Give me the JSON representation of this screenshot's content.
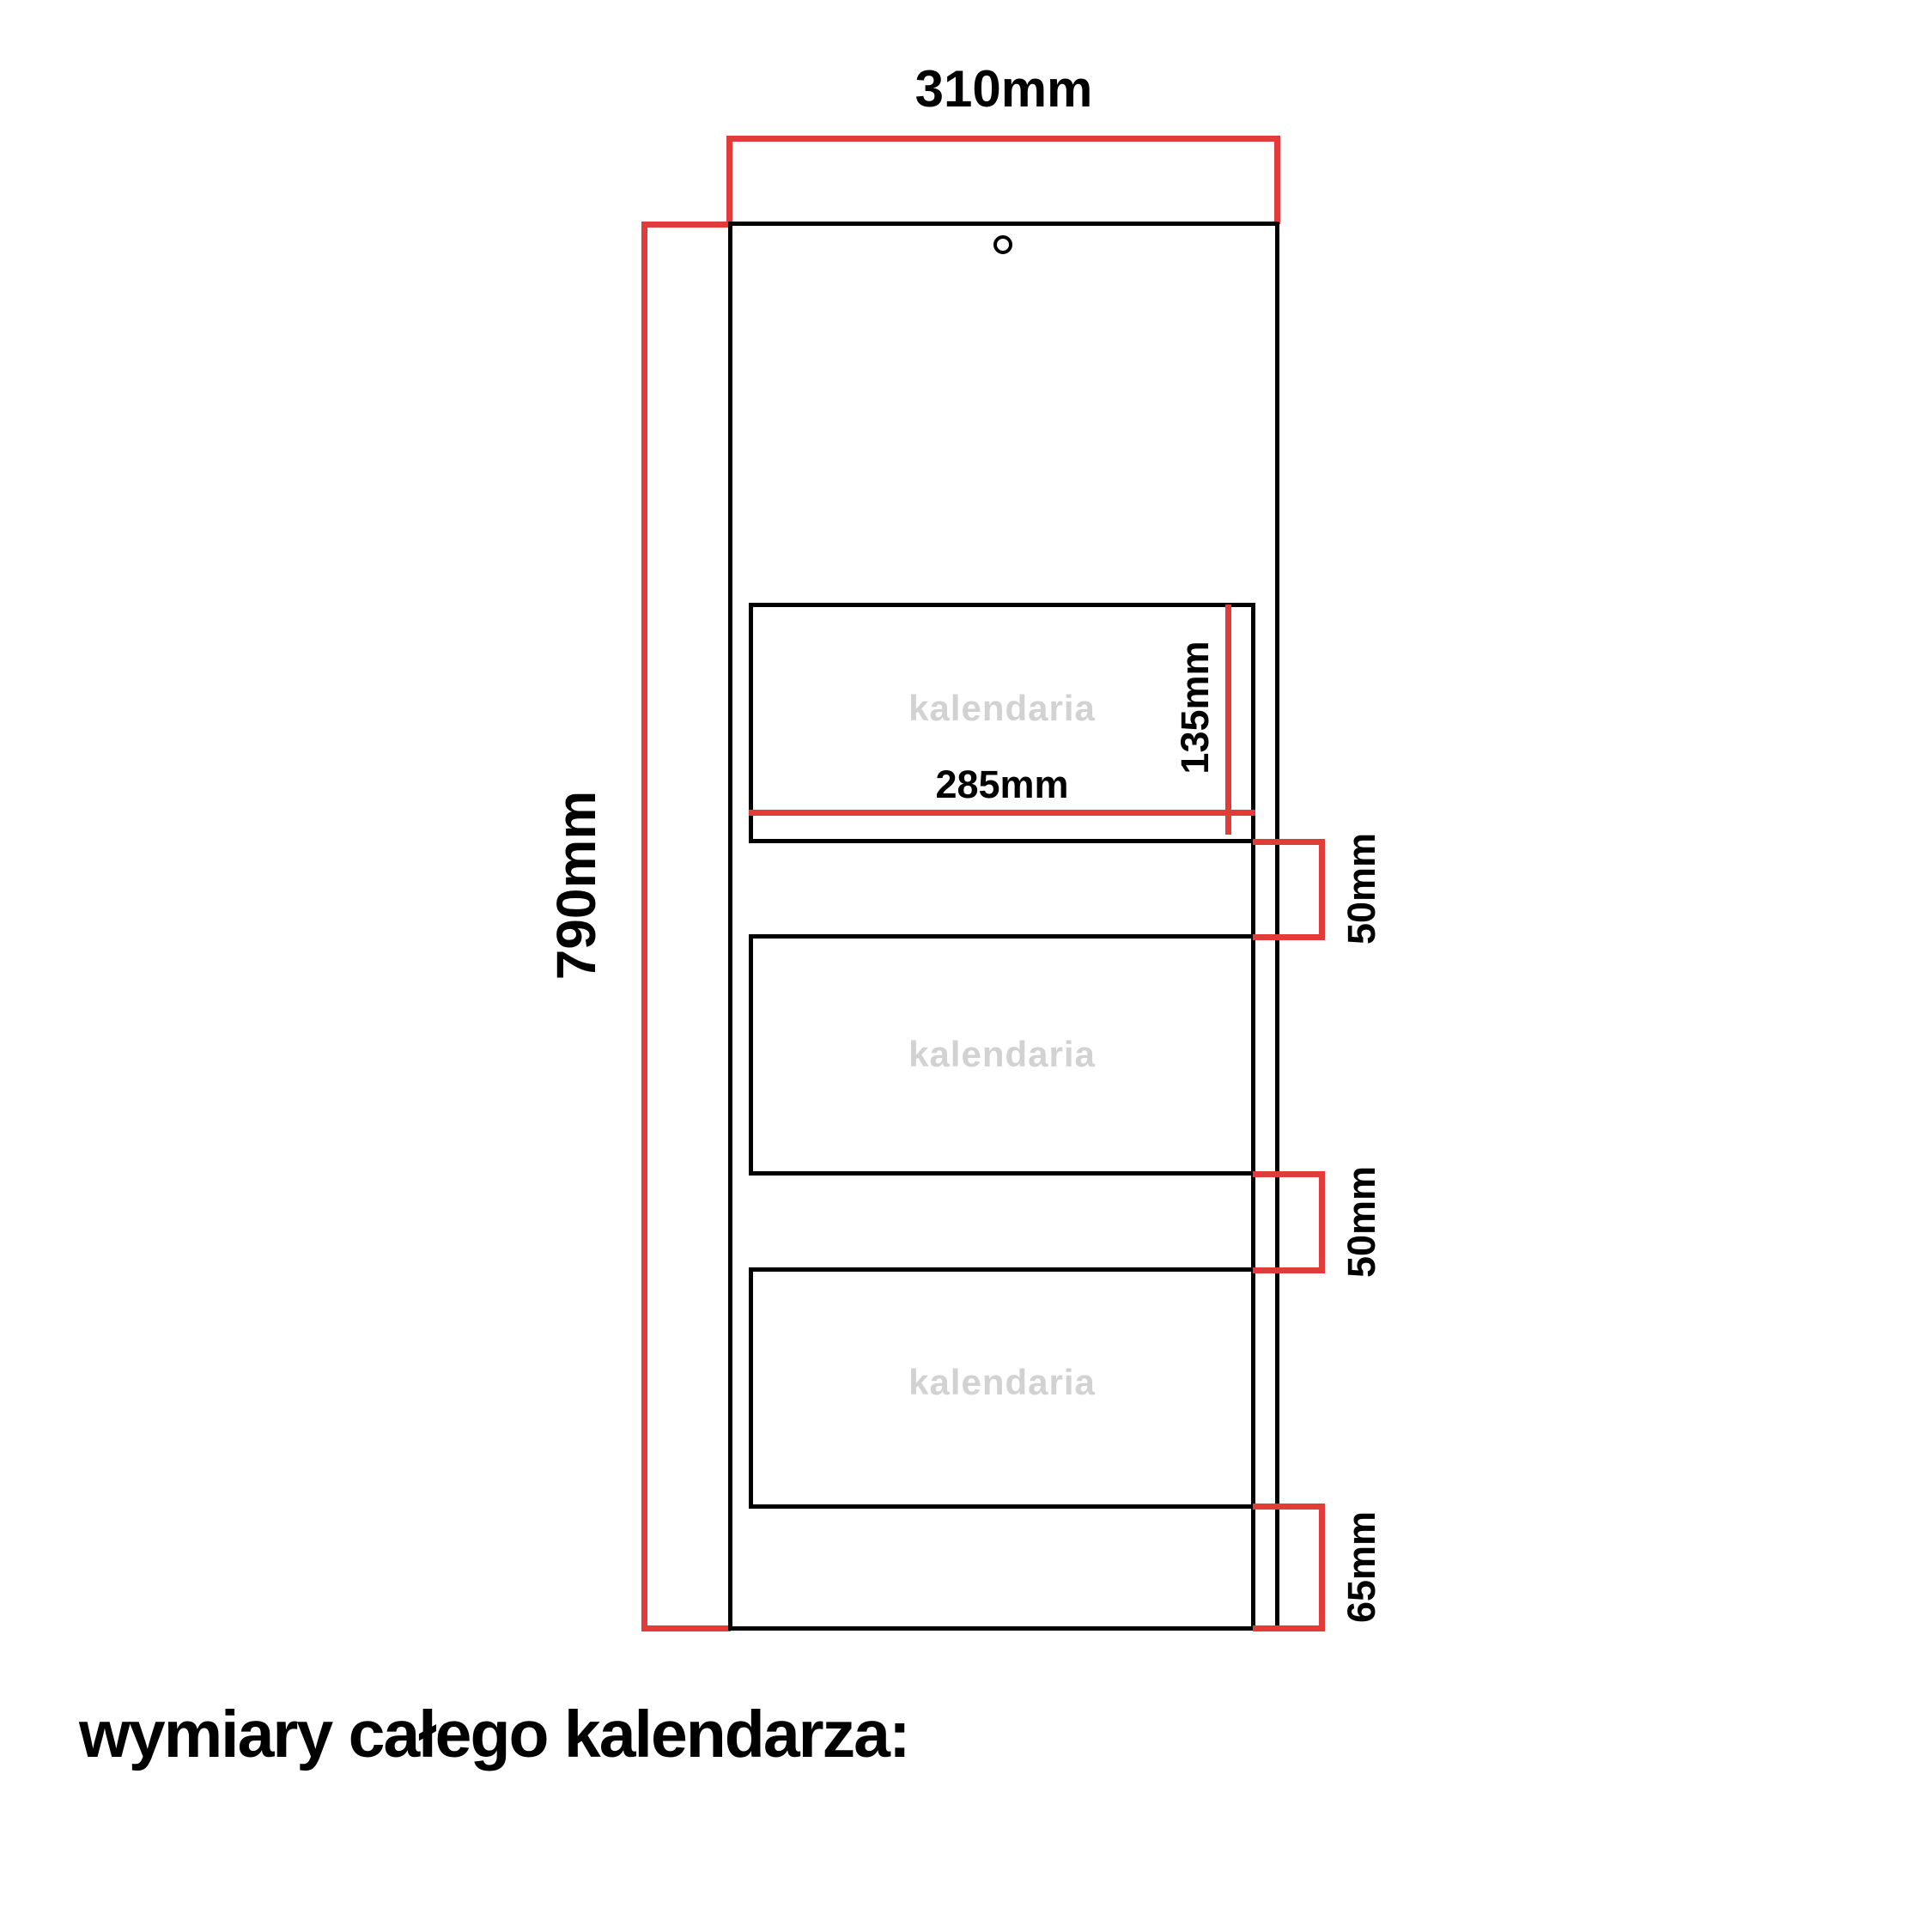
{
  "page": {
    "title": "wymiary całego kalendarza:"
  },
  "colors": {
    "background": "#ffffff",
    "line_black": "#000000",
    "dimension_red": "#e23c3a",
    "watermark_gray": "#d2d2d2"
  },
  "dimensions": {
    "overall_width": "310mm",
    "overall_height": "790mm",
    "pad_width": "285mm",
    "pad_height": "135mm",
    "gap_after_pad1": "50mm",
    "gap_after_pad2": "50mm",
    "bottom_margin": "65mm"
  },
  "pads": [
    {
      "watermark": "kalendaria"
    },
    {
      "watermark": "kalendaria"
    },
    {
      "watermark": "kalendaria"
    }
  ]
}
